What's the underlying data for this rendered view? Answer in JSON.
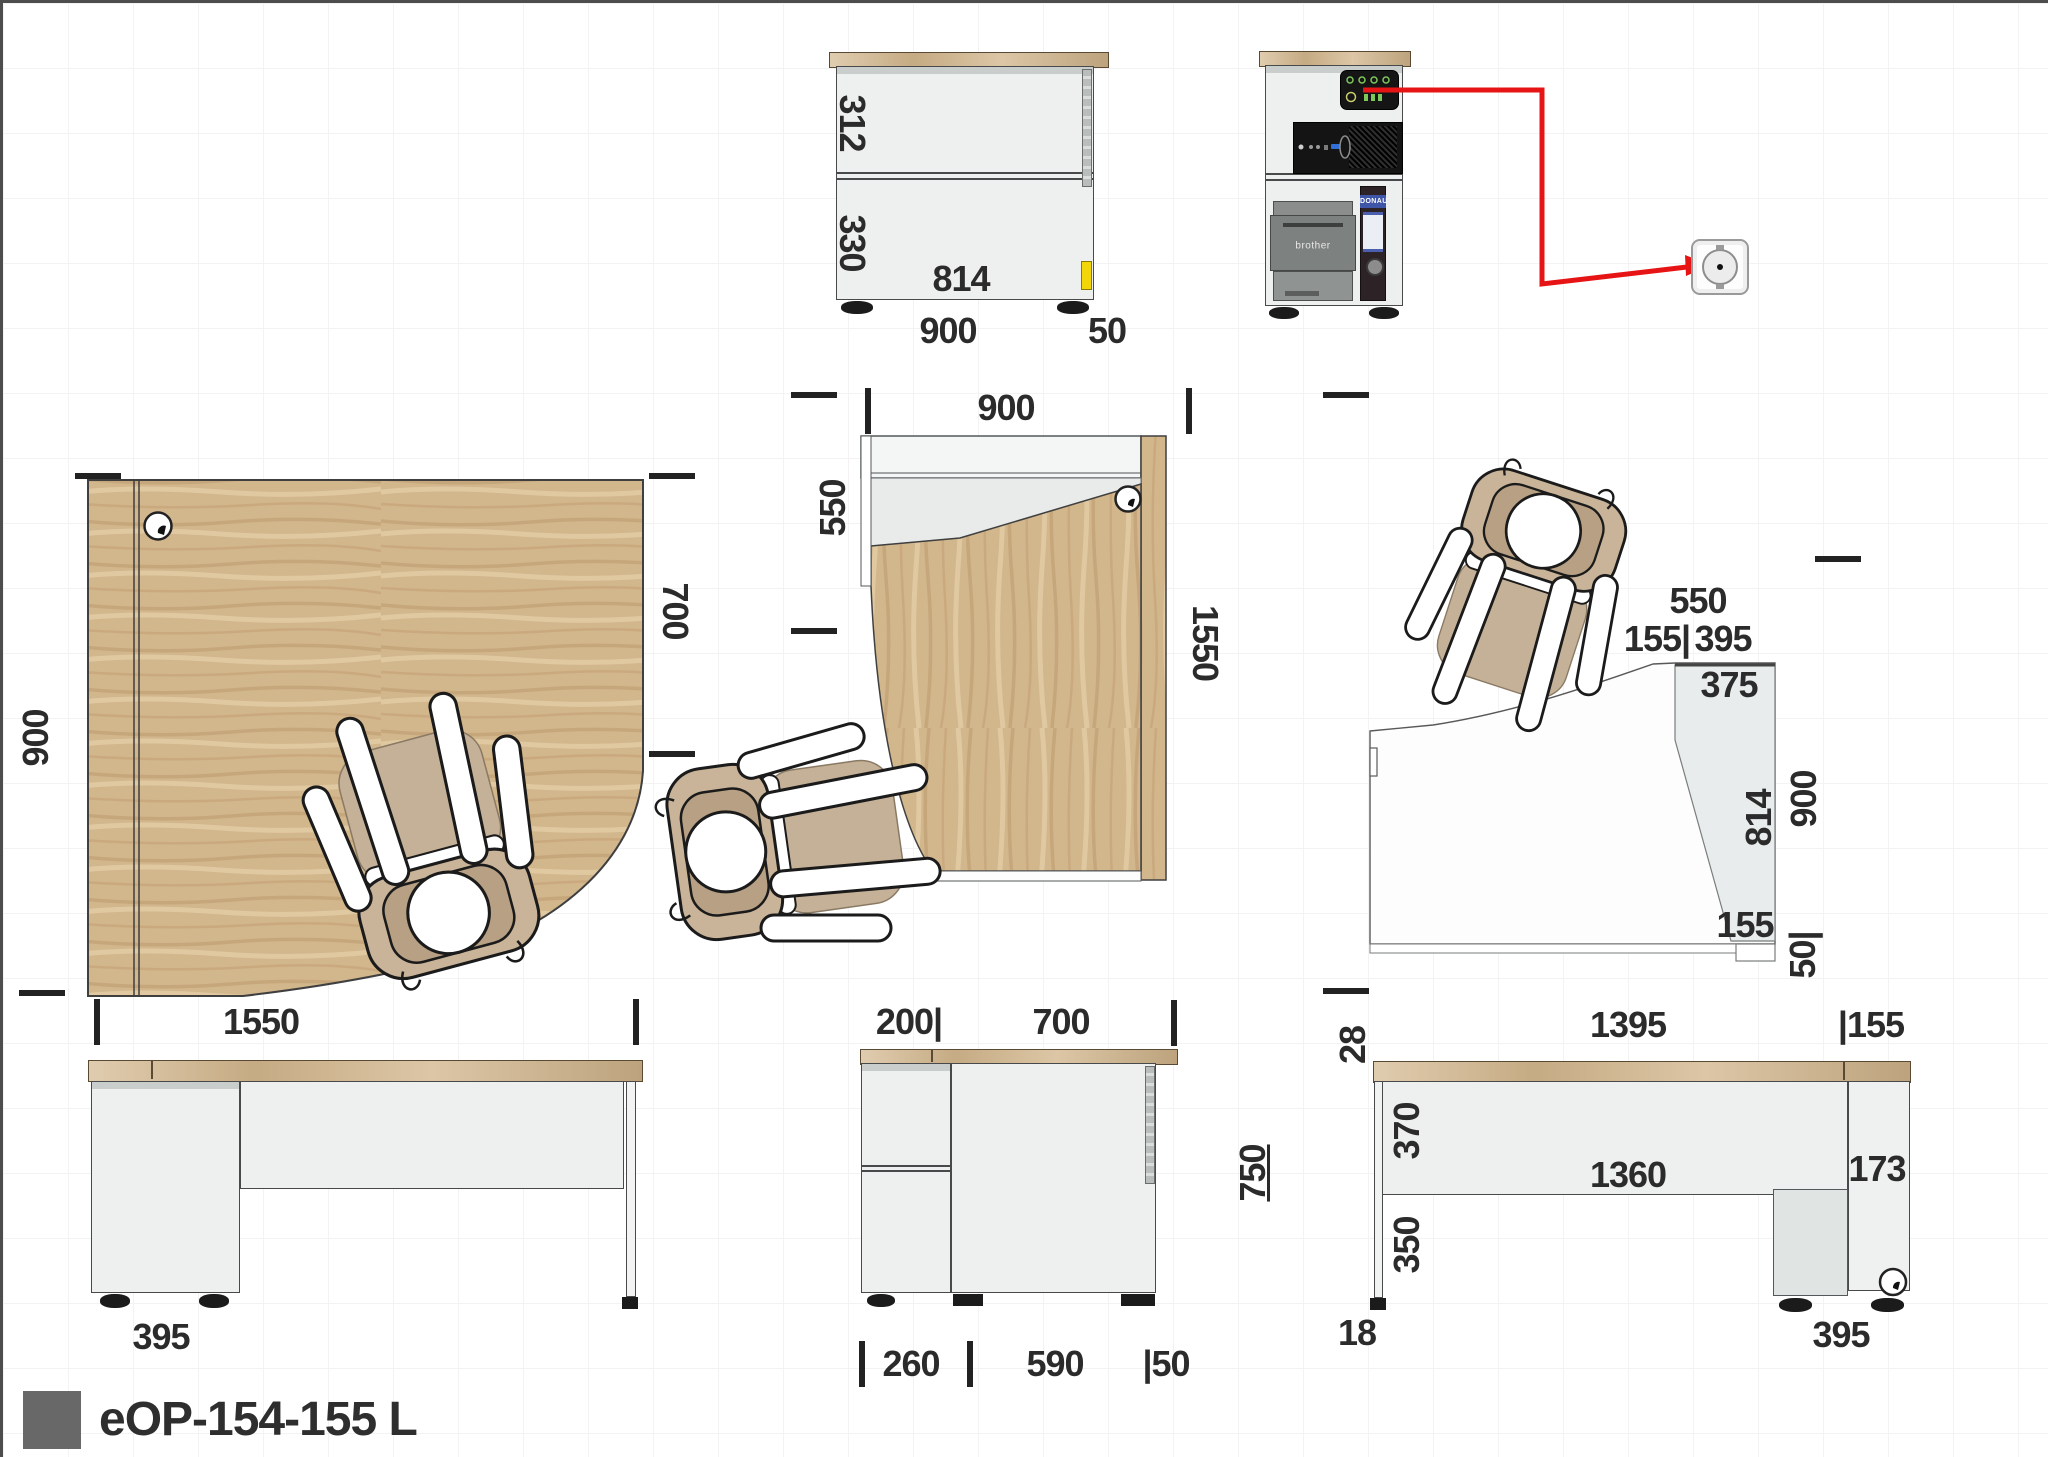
{
  "product": {
    "code": "eOP-154-155 L"
  },
  "colors": {
    "red": "#e61414",
    "yellow": "#f3d608",
    "wood": "#d2b68c"
  },
  "views": {
    "cabinet_front": {
      "h_upper": "312",
      "h_lower": "330",
      "w_inner": "814",
      "w_base": "900",
      "w_side": "50"
    },
    "equipment": {
      "printer": "brother",
      "binder": "DONAU"
    },
    "plan_left": {
      "depth": "900",
      "depth_right": "700"
    },
    "front_left": {
      "width": "1550",
      "cabinet": "395"
    },
    "plan_mid": {
      "width": "900",
      "back": "550",
      "length": "1550",
      "offset": "200|",
      "depth": "700"
    },
    "side_mid": {
      "height": "750",
      "cabinet": "260",
      "panel": "590",
      "edge": "|50"
    },
    "plan_right": {
      "back": "550",
      "seg155": "155|",
      "seg395": "395",
      "inner375": "375",
      "inner814": "814",
      "depth": "900",
      "inner155": "155",
      "edge50": "50|"
    },
    "back_right": {
      "width": "1395",
      "seg155": "|155",
      "top28": "28",
      "panel370": "370",
      "inner1360": "1360",
      "leg350": "350",
      "cab173": "173",
      "foot18": "18",
      "base395": "395"
    }
  }
}
